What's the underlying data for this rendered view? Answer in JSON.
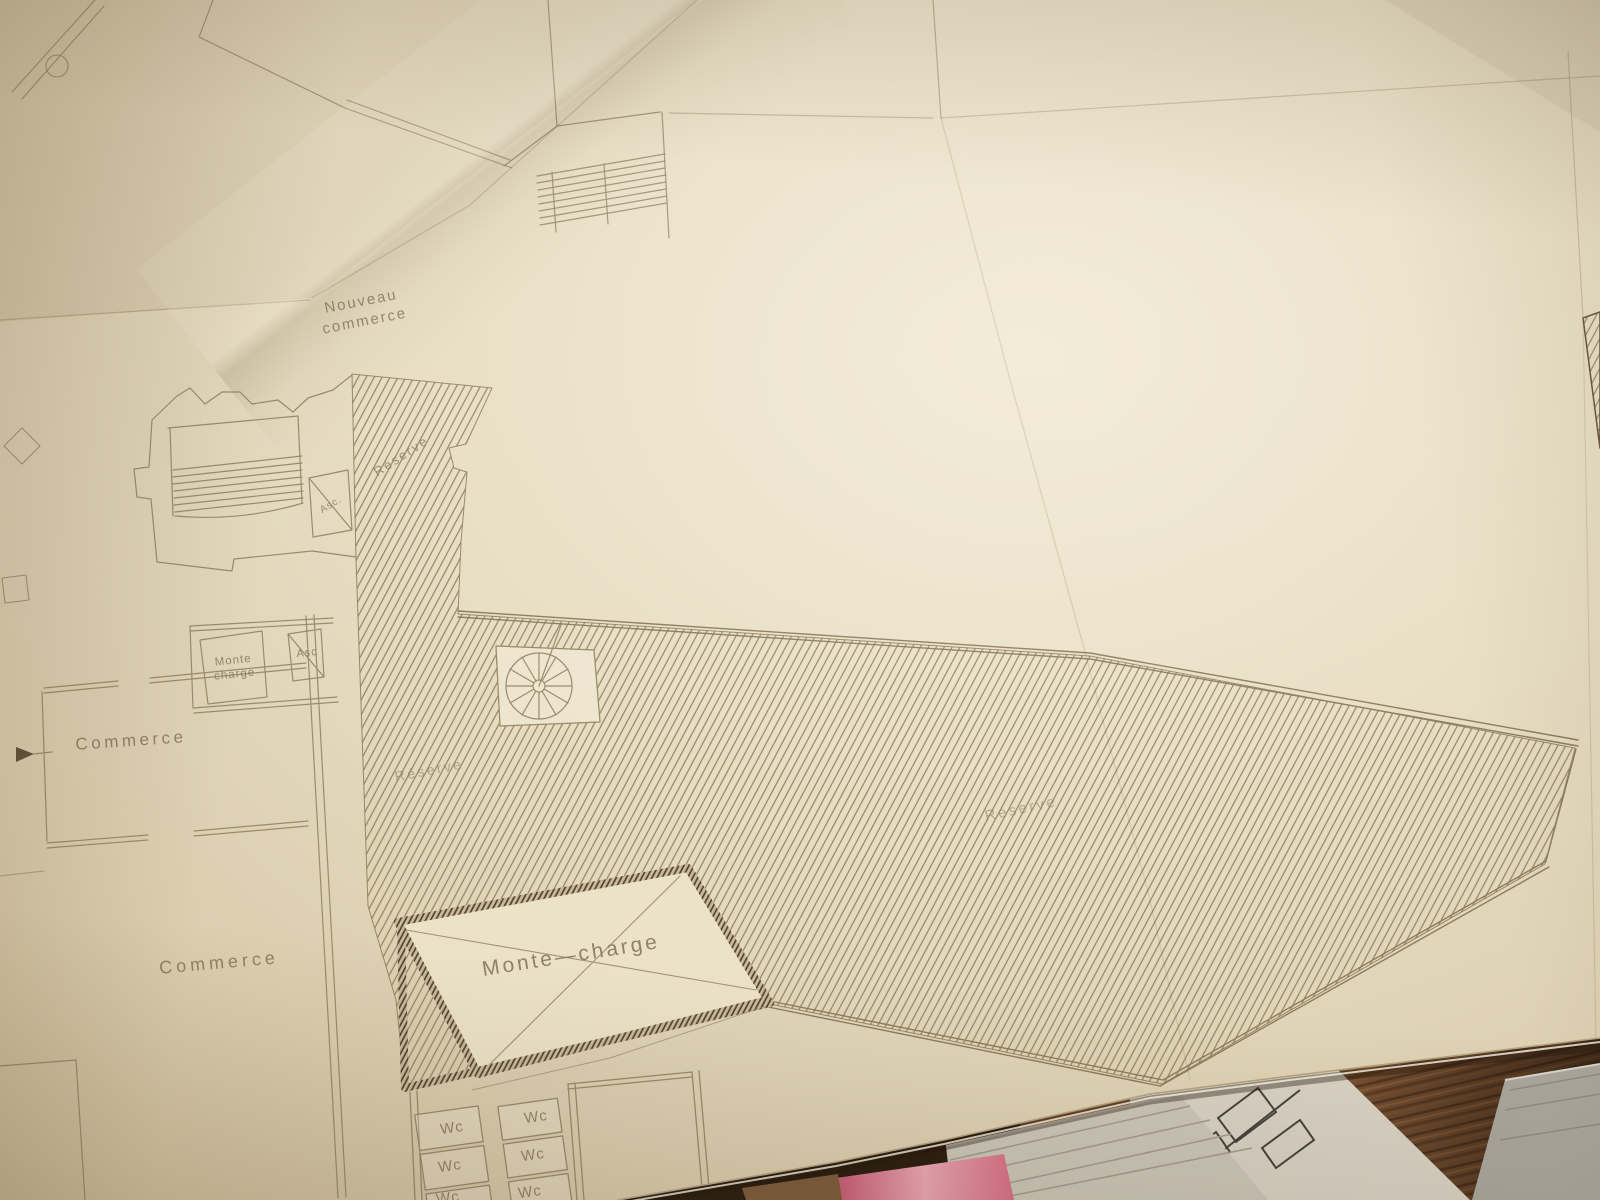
{
  "plan_labels": {
    "nouveau_commerce_line1": "Nouveau",
    "nouveau_commerce_line2": "commerce",
    "reserve_tower": "Réserve",
    "asc_upper": "Asc.",
    "monte_charge_upper_line1": "Monte",
    "monte_charge_upper_line2": "charge",
    "asc_mid": "Asc",
    "commerce_upper": "Commerce",
    "reserve_mid": "Réserve",
    "reserve_right": "Réserve",
    "commerce_lower": "Commerce",
    "monte_charge_main": "Monte—charge",
    "wc_rooms": [
      "Wc",
      "Wc",
      "Wc",
      "Wc",
      "Wc",
      "Wc"
    ]
  },
  "colors": {
    "paper": "#e7ddc3",
    "plan_line": "#9a8b6d",
    "hatch_line": "#93825f",
    "dark_wall": "#54422c",
    "label_text": "#8c7d61",
    "wood_floor": "#7d5434",
    "pink_paper": "#d76f85",
    "gray_paper": "#aaa69c",
    "white_paper": "#d8d2c4"
  }
}
